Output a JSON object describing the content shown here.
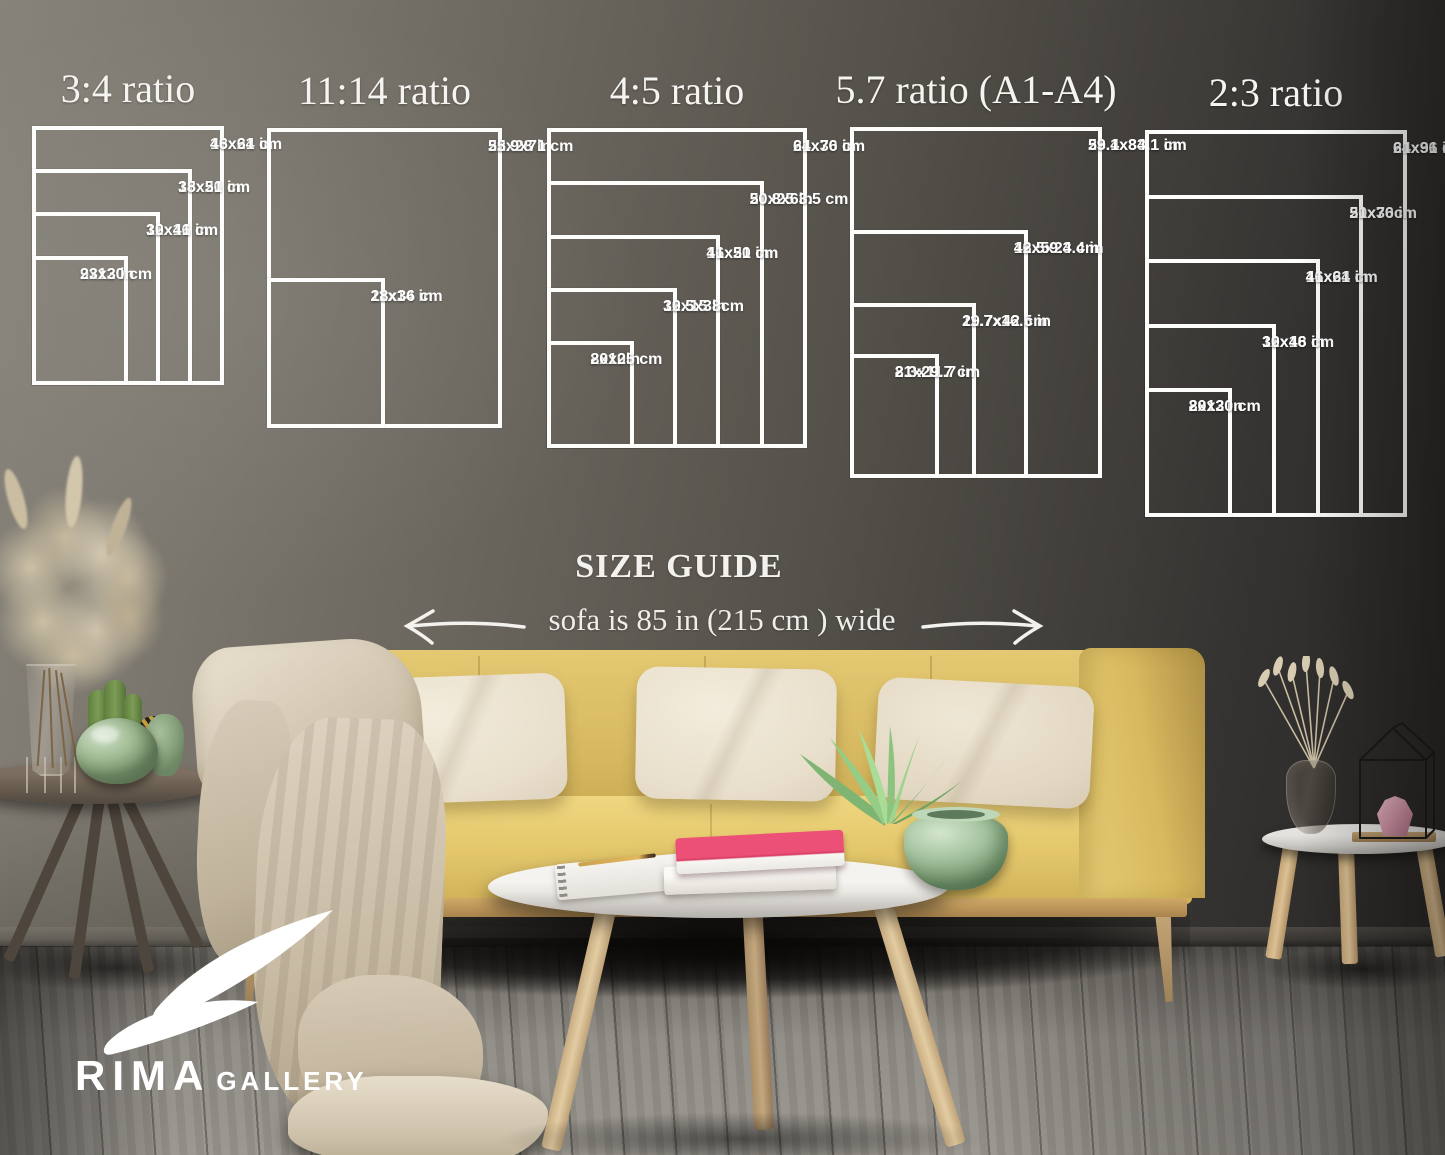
{
  "size_guide": {
    "heading": "SIZE GUIDE",
    "sofa_note": "sofa is 85 in (215 cm ) wide",
    "groups": [
      {
        "title": "3:4 ratio",
        "sizes": [
          {
            "inches": "18x24 in",
            "cm": "46x61 cm",
            "w": 18,
            "h": 24
          },
          {
            "inches": "15x20 in",
            "cm": "38x51 cm",
            "w": 15,
            "h": 20
          },
          {
            "inches": "12x16 in",
            "cm": "30x41 cm",
            "w": 12,
            "h": 16
          },
          {
            "inches": "9x12 in",
            "cm": "23x30 cm",
            "w": 9,
            "h": 12
          }
        ]
      },
      {
        "title": "11:14 ratio",
        "sizes": [
          {
            "inches": "22x28 in",
            "cm": "55.9x71 cm",
            "w": 22,
            "h": 28
          },
          {
            "inches": "11x14 in",
            "cm": "28x36 cm",
            "w": 11,
            "h": 14
          }
        ]
      },
      {
        "title": "4:5 ratio",
        "sizes": [
          {
            "inches": "24x30 in",
            "cm": "61x76 cm",
            "w": 24,
            "h": 30
          },
          {
            "inches": "20x25 in",
            "cm": "50.8x63.5 cm",
            "w": 20,
            "h": 25
          },
          {
            "inches": "16x20 in",
            "cm": "41x51 cm",
            "w": 16,
            "h": 20
          },
          {
            "inches": "12x15 in",
            "cm": "30.5x38cm",
            "w": 12,
            "h": 15
          },
          {
            "inches": "8x10in",
            "cm": "20x25 cm",
            "w": 8,
            "h": 10
          }
        ]
      },
      {
        "title": "5.7 ratio (A1-A4)",
        "sizes": [
          {
            "inches": "23.4x33.1 in",
            "cm": "59.1x84.1 cm",
            "w": 23.4,
            "h": 33.1
          },
          {
            "inches": "16.5x23.4 in",
            "cm": "42x59.4 cm",
            "w": 16.5,
            "h": 23.4
          },
          {
            "inches": "11.7x16.5 in",
            "cm": "29.7x42 cm",
            "w": 11.7,
            "h": 16.5
          },
          {
            "inches": "8.3x11.7 in",
            "cm": "21x29.7 cm",
            "w": 8.3,
            "h": 11.7
          }
        ]
      },
      {
        "title": "2:3 ratio",
        "sizes": [
          {
            "inches": "24x36 in",
            "cm": "61x91 cm",
            "w": 24,
            "h": 36
          },
          {
            "inches": "20x30 in",
            "cm": "51x76cm",
            "w": 20,
            "h": 30
          },
          {
            "inches": "16x24 in",
            "cm": "41x61 cm",
            "w": 16,
            "h": 24
          },
          {
            "inches": "12x18 in",
            "cm": "30x46 cm",
            "w": 12,
            "h": 18
          },
          {
            "inches": "8x12 in",
            "cm": "20x30 cm",
            "w": 8,
            "h": 12
          }
        ]
      }
    ]
  },
  "brand": {
    "name": "RIMA",
    "suffix": "GALLERY"
  },
  "colors": {
    "frame_line": "#ffffff",
    "wall_left": "#87837a",
    "wall_right": "#272523",
    "sofa_yellow": "#e0c369",
    "pillow_cream": "#ece3d0",
    "floor_gray": "#8b8781",
    "book_pink": "#ea4a72",
    "vase_green": "#a6c5a0"
  }
}
